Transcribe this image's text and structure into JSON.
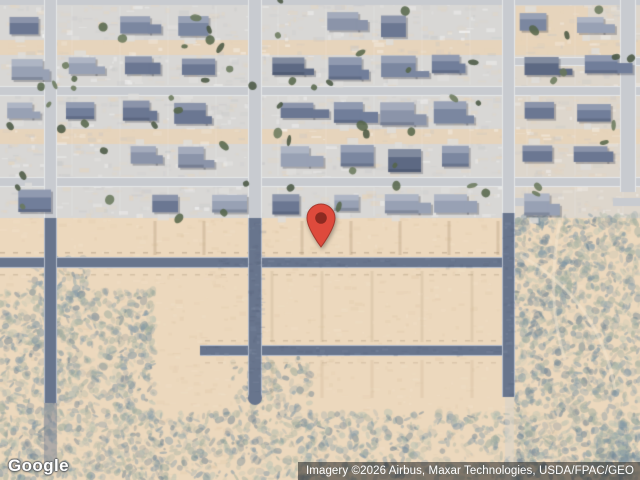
{
  "map": {
    "view": "satellite",
    "marker": {
      "name": "location-pin",
      "tip_x": 321,
      "tip_y": 248,
      "fill": "#DE4A3C",
      "stroke": "#A63A2F",
      "dot": "#8C2A21"
    }
  },
  "branding": {
    "logo_text": "Google"
  },
  "attribution": {
    "text": "Imagery ©2026 Airbus, Maxar Technologies, USDA/FPAC/GEO"
  },
  "palette": {
    "sand": "#ecd8bd",
    "sand_light": "#f6e8d2",
    "sand_dark": "#dcc3a2",
    "lot": "#d8d7d5",
    "lot_tan": "#e8d4b9",
    "street_light": "#c8cbd0",
    "street_light_curb": "#eceeee",
    "street_dark": "#68758d",
    "street_dark_curb": "#c7cfdc",
    "lot_line": "#c2ab8c",
    "roof": [
      "#6b7792",
      "#7b87a0",
      "#8b94a9",
      "#5d6983",
      "#98a1b4",
      "#717e9a"
    ],
    "tree": [
      "#556549",
      "#68785a",
      "#47553f"
    ],
    "scrub": [
      "#8ba0ab",
      "#9cab9e",
      "#7b93a3",
      "#aab4a6",
      "#bac3b4",
      "#6d8292"
    ]
  }
}
